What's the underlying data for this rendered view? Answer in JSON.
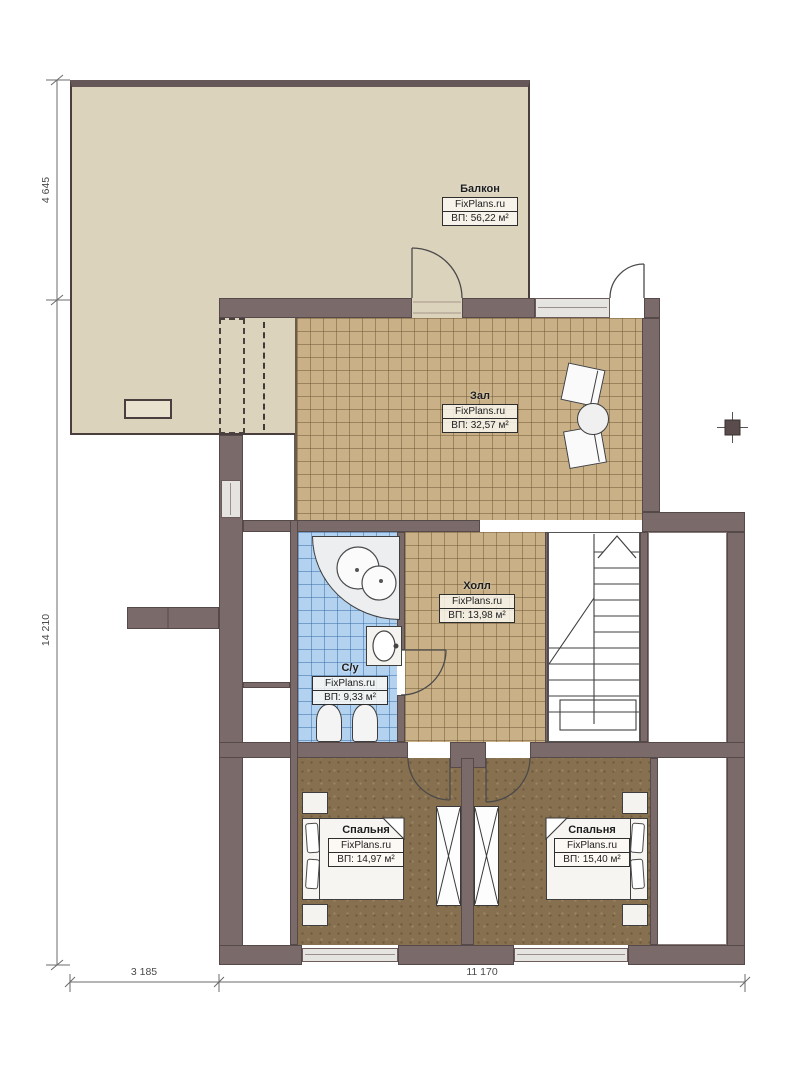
{
  "brand": "FixPlans.ru",
  "rooms": {
    "balcony": {
      "name": "Балкон",
      "area": "ВП: 56,22 м²"
    },
    "zal": {
      "name": "Зал",
      "area": "ВП: 32,57 м²"
    },
    "hall": {
      "name": "Холл",
      "area": "ВП: 13,98 м²"
    },
    "bathroom": {
      "name": "С/у",
      "area": "ВП: 9,33 м²"
    },
    "bedroom_left": {
      "name": "Спальня",
      "area": "ВП: 14,97 м²"
    },
    "bedroom_right": {
      "name": "Спальня",
      "area": "ВП: 15,40 м²"
    }
  },
  "dimensions": {
    "left_upper": "4 645",
    "left_lower": "14 210",
    "bottom_left": "3 185",
    "bottom_right": "11 170"
  },
  "colors": {
    "wall": "#7b6a6a",
    "wall_edge": "#564949",
    "balcony_floor": "#dcd3bd",
    "tile_tan": "#c9b086",
    "tile_blue": "#b3d2ef",
    "bedroom_floor": "#87704f",
    "window_fill": "#e6e4e0"
  }
}
